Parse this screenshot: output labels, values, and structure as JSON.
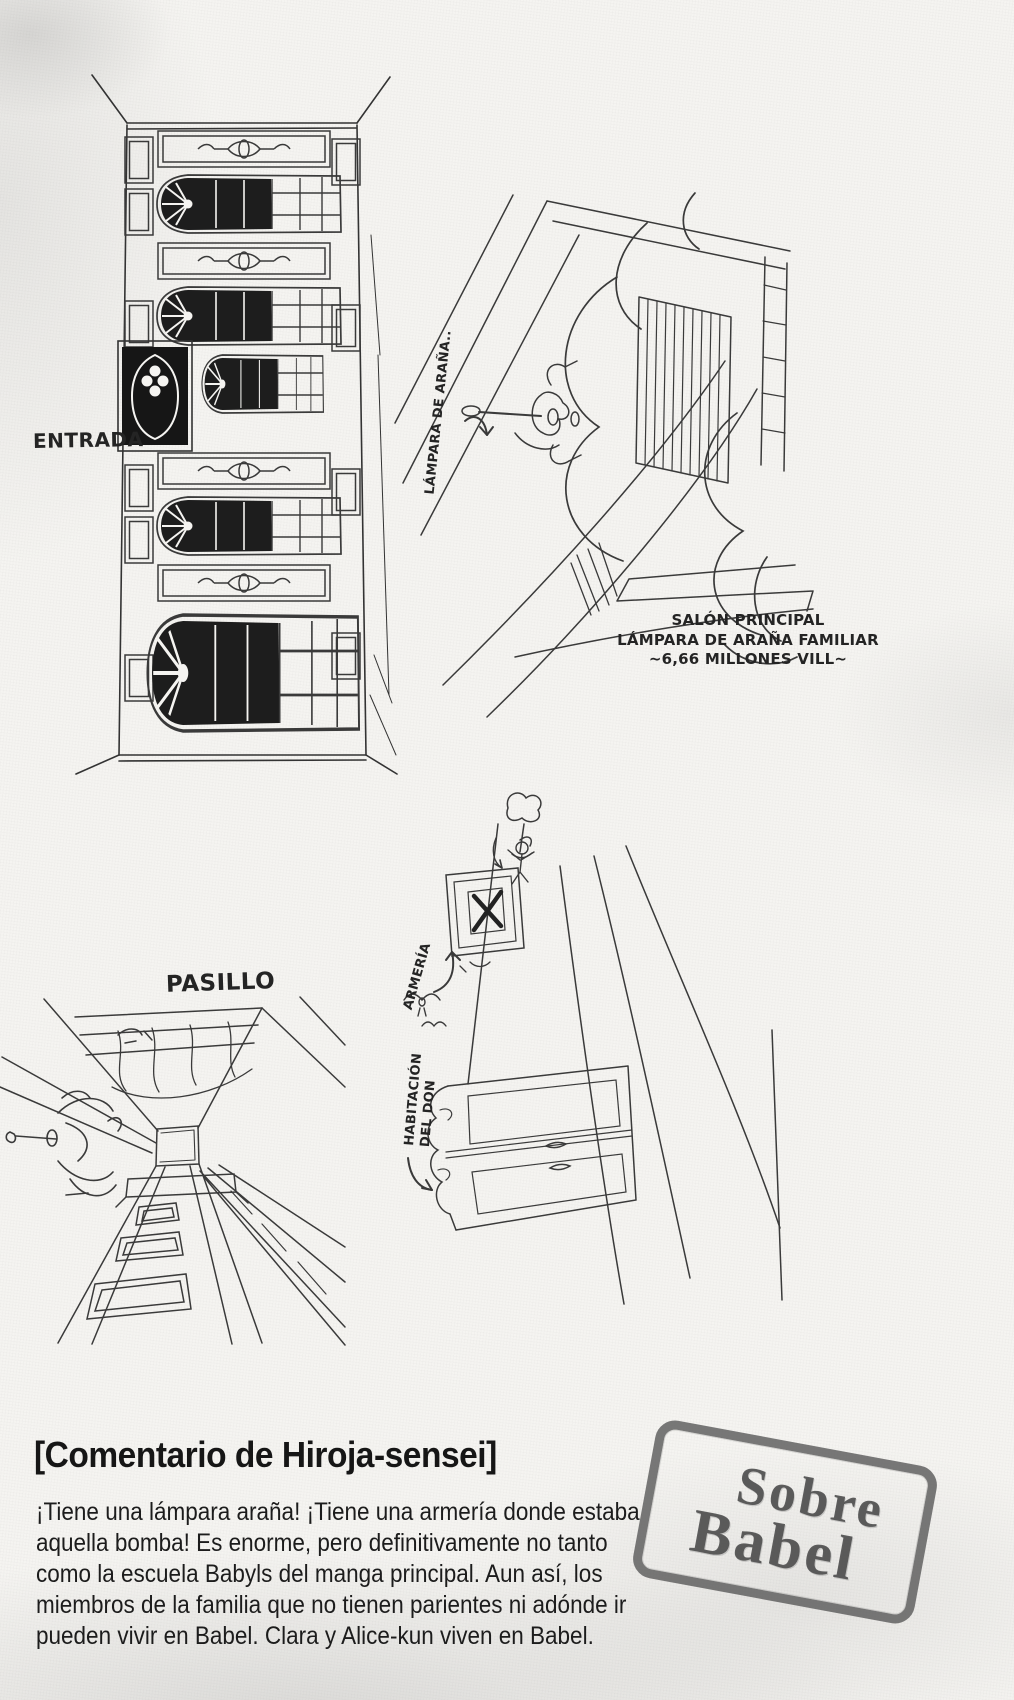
{
  "labels": {
    "entrada": "ENTRADA",
    "lampara": "LÁMPARA DE ARAÑA..",
    "salon": [
      "SALÓN PRINCIPAL",
      "LÁMPARA DE ARAÑA FAMILIAR",
      "~6,66 MILLONES VILL~"
    ],
    "pasillo": "PASILLO",
    "armeria": "ARMERÍA",
    "habitacion": [
      "HABITACIÓN",
      "DEL DON"
    ]
  },
  "commentary": {
    "heading": "[Comentario de Hiroja-sensei]",
    "lines": [
      "¡Tiene una lámpara araña! ¡Tiene una armería donde estaba",
      "aquella bomba! Es enorme, pero definitivamente no tanto",
      "como la escuela Babyls del manga principal. Aun así, los",
      "miembros de la familia que no tienen parientes ni adónde ir",
      "pueden vivir en Babel. Clara y Alice-kun viven en Babel."
    ]
  },
  "stamp": {
    "line1": "Sobre",
    "line2": "Babel"
  },
  "colors": {
    "ink": "#2f2f2f",
    "paper": "#f5f4f1",
    "stamp": "#5a5a5a"
  }
}
